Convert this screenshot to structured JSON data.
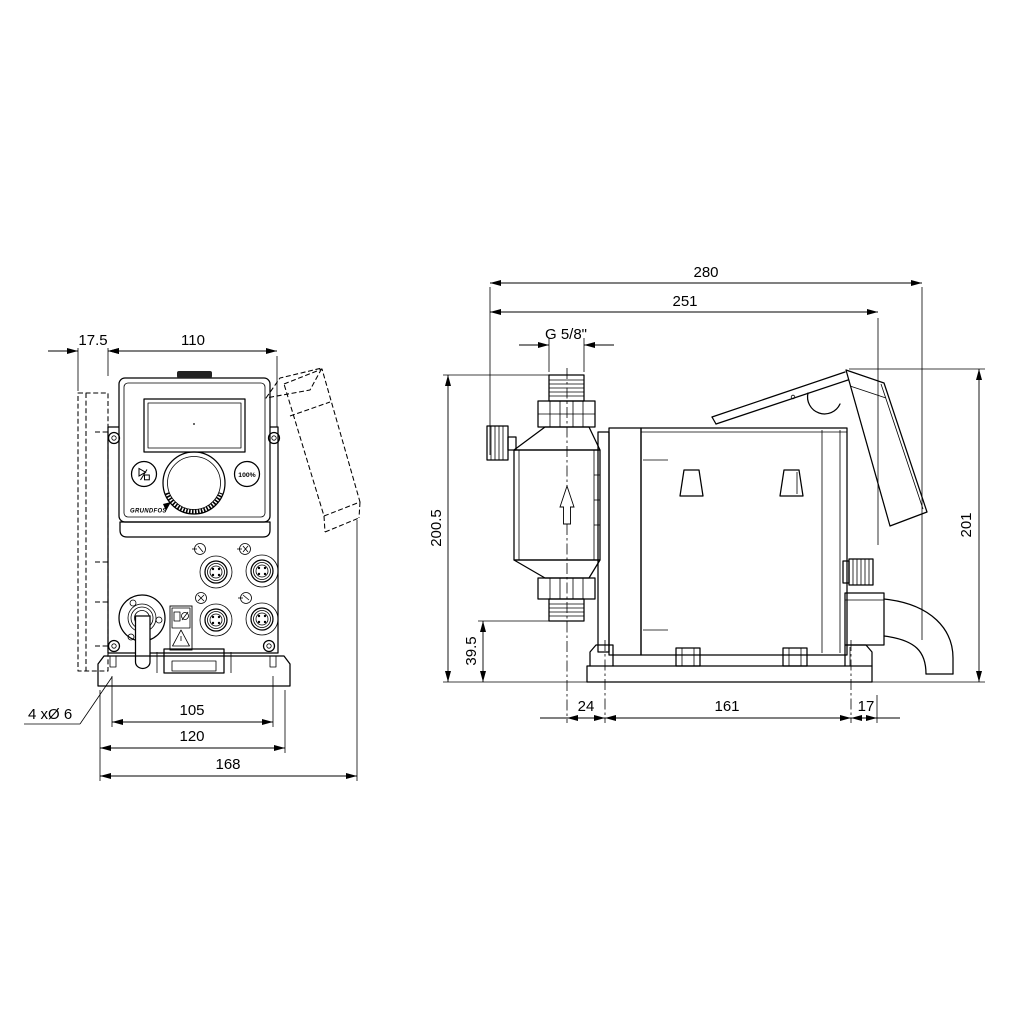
{
  "drawing": {
    "kind": "technical dimensional drawing",
    "subject": "dosing pump, front and side views"
  },
  "front": {
    "name": "front-view",
    "dims": {
      "bracket_offset": "17.5",
      "housing_width": "110",
      "mount_hole_pitch": "105",
      "mount_plate_width": "120",
      "overall_width": "168",
      "mounting_holes_note": "4 xØ 6"
    },
    "panel": {
      "full_capacity_button_label": "100%",
      "brand_logo_text": "GRUNDFOS"
    }
  },
  "side": {
    "name": "side-view",
    "dims": {
      "overall_depth": "280",
      "housing_depth": "251",
      "connection_thread": "G 5/8\"",
      "overall_height": "200.5",
      "valve_outlet_height": "39.5",
      "plug_height": "201",
      "head_center_to_slot": "24",
      "slot_pitch": "161",
      "slot_to_edge": "17"
    }
  },
  "colors": {
    "line": "#000000",
    "background": "#ffffff"
  }
}
